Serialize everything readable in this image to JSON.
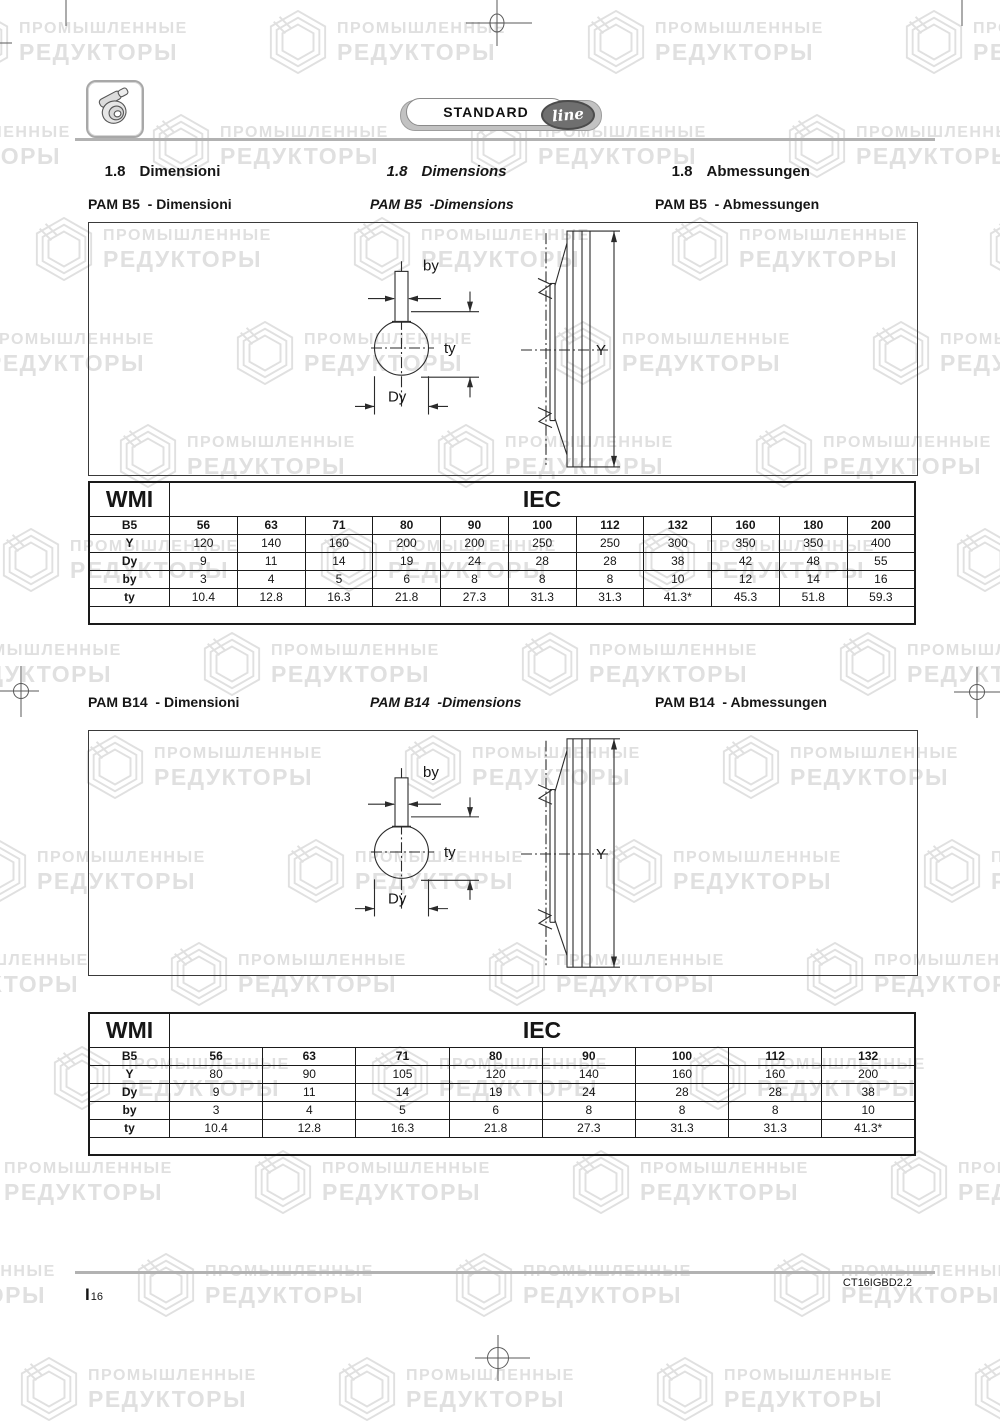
{
  "watermark": {
    "line1": "ПРОМЫШЛЕННЫЕ",
    "line2": "РЕДУКТОРЫ"
  },
  "badge": {
    "standard": "STANDARD",
    "line": "line"
  },
  "headings": {
    "it": {
      "num": "1.8",
      "label": "Dimensioni"
    },
    "en": {
      "num": "1.8",
      "label": "Dimensions"
    },
    "de": {
      "num": "1.8",
      "label": "Abmessungen"
    }
  },
  "sections": [
    {
      "id": "pam-b5",
      "subtitles": {
        "it": "PAM B5  - Dimensioni",
        "en": "PAM B5  -Dimensions",
        "de": "PAM B5  - Abmessungen"
      },
      "diagram": {
        "by": "by",
        "ty": "ty",
        "dy": "Dy",
        "y": "Y"
      },
      "table": {
        "corner": "WMI",
        "group": "IEC",
        "rows": [
          {
            "label": "B5",
            "bold": true,
            "values": [
              "56",
              "63",
              "71",
              "80",
              "90",
              "100",
              "112",
              "132",
              "160",
              "180",
              "200"
            ]
          },
          {
            "label": "Y",
            "values": [
              "120",
              "140",
              "160",
              "200",
              "200",
              "250",
              "250",
              "300",
              "350",
              "350",
              "400"
            ]
          },
          {
            "label": "Dy",
            "values": [
              "9",
              "11",
              "14",
              "19",
              "24",
              "28",
              "28",
              "38",
              "42",
              "48",
              "55"
            ]
          },
          {
            "label": "by",
            "values": [
              "3",
              "4",
              "5",
              "6",
              "8",
              "8",
              "8",
              "10",
              "12",
              "14",
              "16"
            ]
          },
          {
            "label": "ty",
            "values": [
              "10.4",
              "12.8",
              "16.3",
              "21.8",
              "27.3",
              "31.3",
              "31.3",
              "41.3*",
              "45.3",
              "51.8",
              "59.3"
            ]
          }
        ]
      }
    },
    {
      "id": "pam-b14",
      "subtitles": {
        "it": "PAM B14  - Dimensioni",
        "en": "PAM B14  -Dimensions",
        "de": "PAM B14  - Abmessungen"
      },
      "diagram": {
        "by": "by",
        "ty": "ty",
        "dy": "Dy",
        "y": "Y"
      },
      "table": {
        "corner": "WMI",
        "group": "IEC",
        "rows": [
          {
            "label": "B5",
            "bold": true,
            "values": [
              "56",
              "63",
              "71",
              "80",
              "90",
              "100",
              "112",
              "132"
            ]
          },
          {
            "label": "Y",
            "values": [
              "80",
              "90",
              "105",
              "120",
              "140",
              "160",
              "160",
              "200"
            ]
          },
          {
            "label": "Dy",
            "values": [
              "9",
              "11",
              "14",
              "19",
              "24",
              "28",
              "28",
              "38"
            ]
          },
          {
            "label": "by",
            "values": [
              "3",
              "4",
              "5",
              "6",
              "8",
              "8",
              "8",
              "10"
            ]
          },
          {
            "label": "ty",
            "values": [
              "10.4",
              "12.8",
              "16.3",
              "21.8",
              "27.3",
              "31.3",
              "31.3",
              "41.3*"
            ]
          }
        ]
      }
    }
  ],
  "footer": {
    "page_prefix": "I",
    "page_number": "16",
    "doc_code": "CT16IGBD2.2"
  }
}
